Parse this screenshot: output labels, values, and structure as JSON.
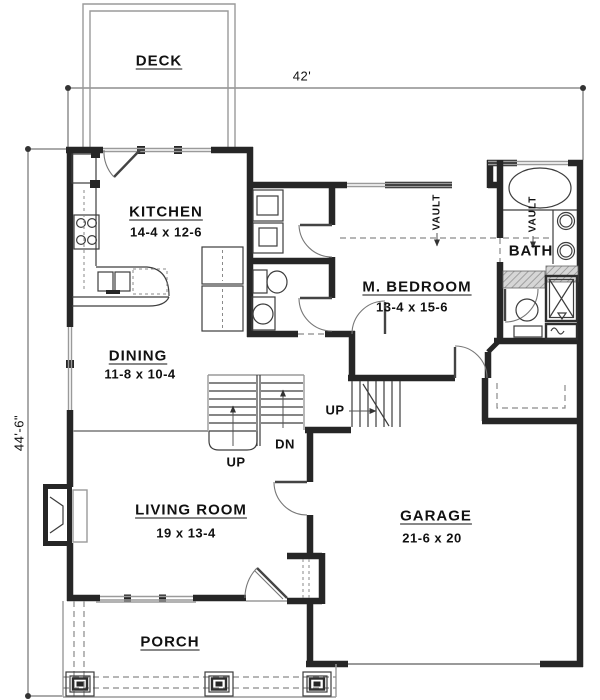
{
  "plan": {
    "dimensions": {
      "width_label": "42'",
      "height_label": "44'-6\""
    },
    "rooms": [
      {
        "id": "deck",
        "name": "DECK",
        "dims": ""
      },
      {
        "id": "kitchen",
        "name": "KITCHEN",
        "dims": "14-4 x 12-6"
      },
      {
        "id": "dining",
        "name": "DINING",
        "dims": "11-8 x 10-4"
      },
      {
        "id": "master_bedroom",
        "name": "M. BEDROOM",
        "dims": "13-4 x 15-6"
      },
      {
        "id": "bath",
        "name": "BATH",
        "dims": ""
      },
      {
        "id": "living_room",
        "name": "LIVING ROOM",
        "dims": "19 x 13-4"
      },
      {
        "id": "garage",
        "name": "GARAGE",
        "dims": "21-6 x 20"
      },
      {
        "id": "porch",
        "name": "PORCH",
        "dims": ""
      }
    ],
    "annotations": {
      "up_main": "UP",
      "dn": "DN",
      "up_garage": "UP",
      "vault_bedroom": "VAULT",
      "vault_bath": "VAULT"
    },
    "colors": {
      "wall": "#262626",
      "line": "#3d3d3d",
      "gray": "#9a9a9a",
      "dash": "#8a8a8a",
      "bg": "#ffffff",
      "text": "#111111"
    }
  }
}
